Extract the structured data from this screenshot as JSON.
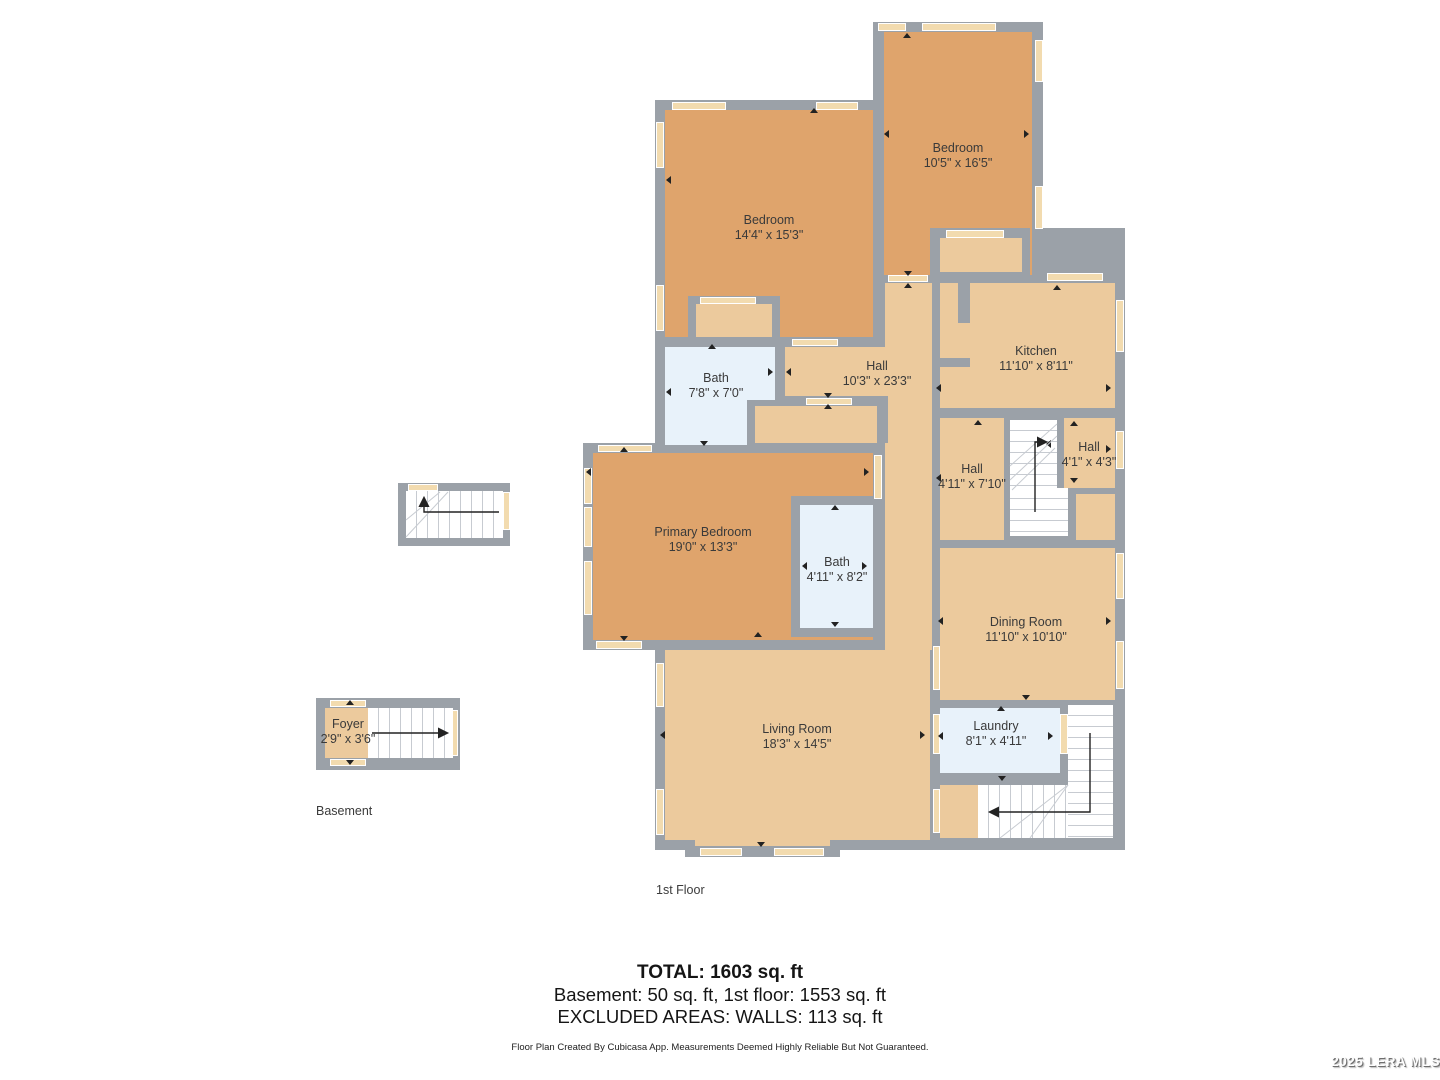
{
  "floor_labels": {
    "basement": "Basement",
    "first": "1st Floor"
  },
  "rooms": [
    {
      "name": "Bedroom",
      "dims": "10'5\" x 16'5\""
    },
    {
      "name": "Bedroom",
      "dims": "14'4\" x 15'3\""
    },
    {
      "name": "Bath",
      "dims": "7'8\" x 7'0\""
    },
    {
      "name": "Hall",
      "dims": "10'3\" x 23'3\""
    },
    {
      "name": "Kitchen",
      "dims": "11'10\" x 8'11\""
    },
    {
      "name": "Hall",
      "dims": "4'11\" x 7'10\""
    },
    {
      "name": "Hall",
      "dims": "4'1\" x 4'3\""
    },
    {
      "name": "Primary Bedroom",
      "dims": "19'0\" x 13'3\""
    },
    {
      "name": "Bath",
      "dims": "4'11\" x 8'2\""
    },
    {
      "name": "Dining Room",
      "dims": "11'10\" x 10'10\""
    },
    {
      "name": "Living Room",
      "dims": "18'3\" x 14'5\""
    },
    {
      "name": "Laundry",
      "dims": "8'1\" x 4'11\""
    },
    {
      "name": "Foyer",
      "dims": "2'9\" x 3'6\""
    }
  ],
  "summary": {
    "total": "TOTAL: 1603 sq. ft",
    "breakdown": "Basement: 50 sq. ft, 1st floor: 1553 sq. ft",
    "excluded": "EXCLUDED AREAS: WALLS: 113 sq. ft",
    "disclaimer": "Floor Plan Created By Cubicasa App. Measurements Deemed Highly Reliable But Not Guaranteed."
  },
  "watermark": "2025 LERA MLS",
  "colors": {
    "wall": "#9BA1A8",
    "bedroom": "#DFA46C",
    "common_area": "#ECCA9D",
    "wet_room": "#E8F2FA",
    "window_marker": "#F2DBAF",
    "stairs": "#FFFFFF"
  }
}
